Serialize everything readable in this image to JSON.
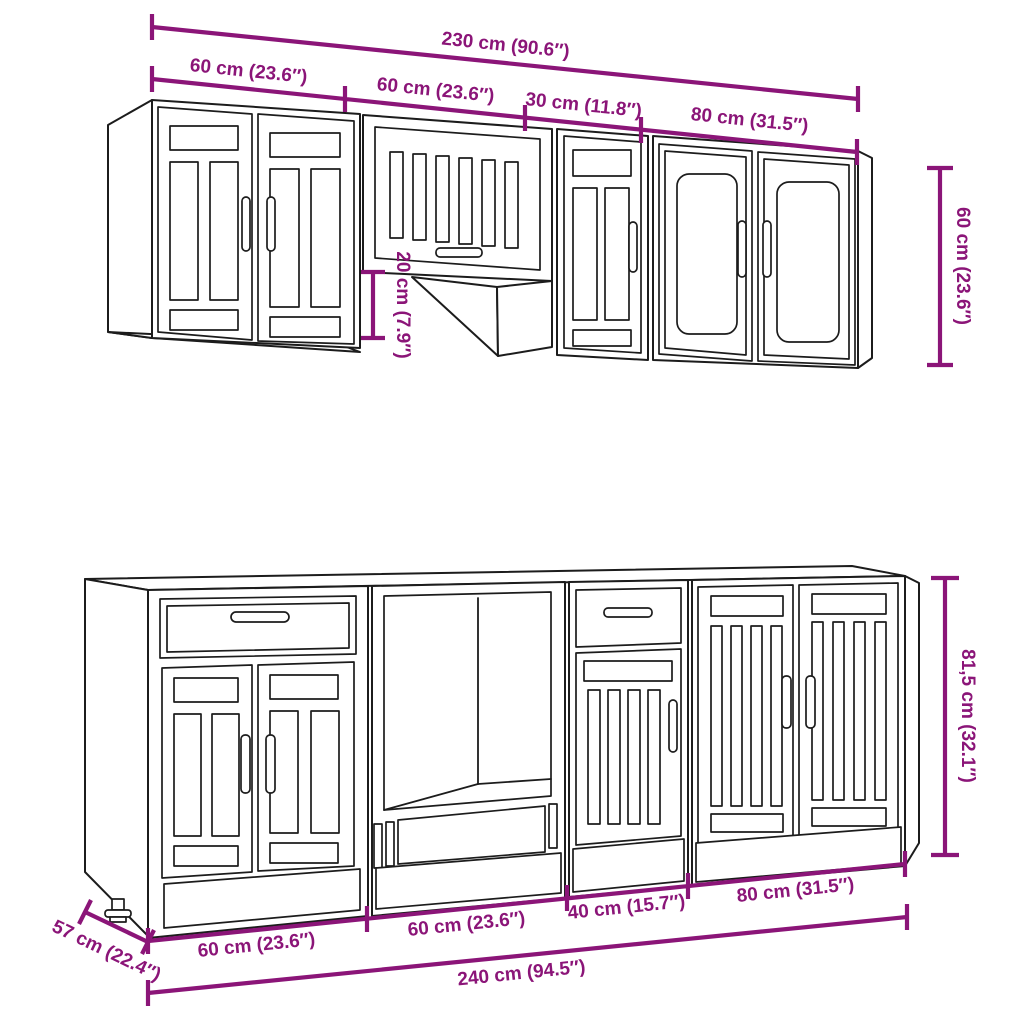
{
  "diagram": {
    "description": "Kitchen cabinet set technical dimension drawing",
    "colors": {
      "background": "#ffffff",
      "cabinet_line": "#1c1c1c",
      "dimension": "#8b1578"
    },
    "dimensions": {
      "total_top": "230 cm (90.6″)",
      "wall_left_60": "60 cm (23.6″)",
      "wall_mid_60": "60 cm (23.6″)",
      "wall_30": "30 cm (11.8″)",
      "wall_80": "80 cm (31.5″)",
      "wall_height_60": "60 cm (23.6″)",
      "hood_20": "20 cm (7.9″)",
      "base_height_815": "81,5 cm (32.1″)",
      "base_left_60": "60 cm (23.6″)",
      "base_mid_60": "60 cm (23.6″)",
      "base_40": "40 cm (15.7″)",
      "base_80": "80 cm (31.5″)",
      "total_bottom": "240 cm (94.5″)",
      "base_depth_57": "57 cm (22.4″)"
    }
  }
}
